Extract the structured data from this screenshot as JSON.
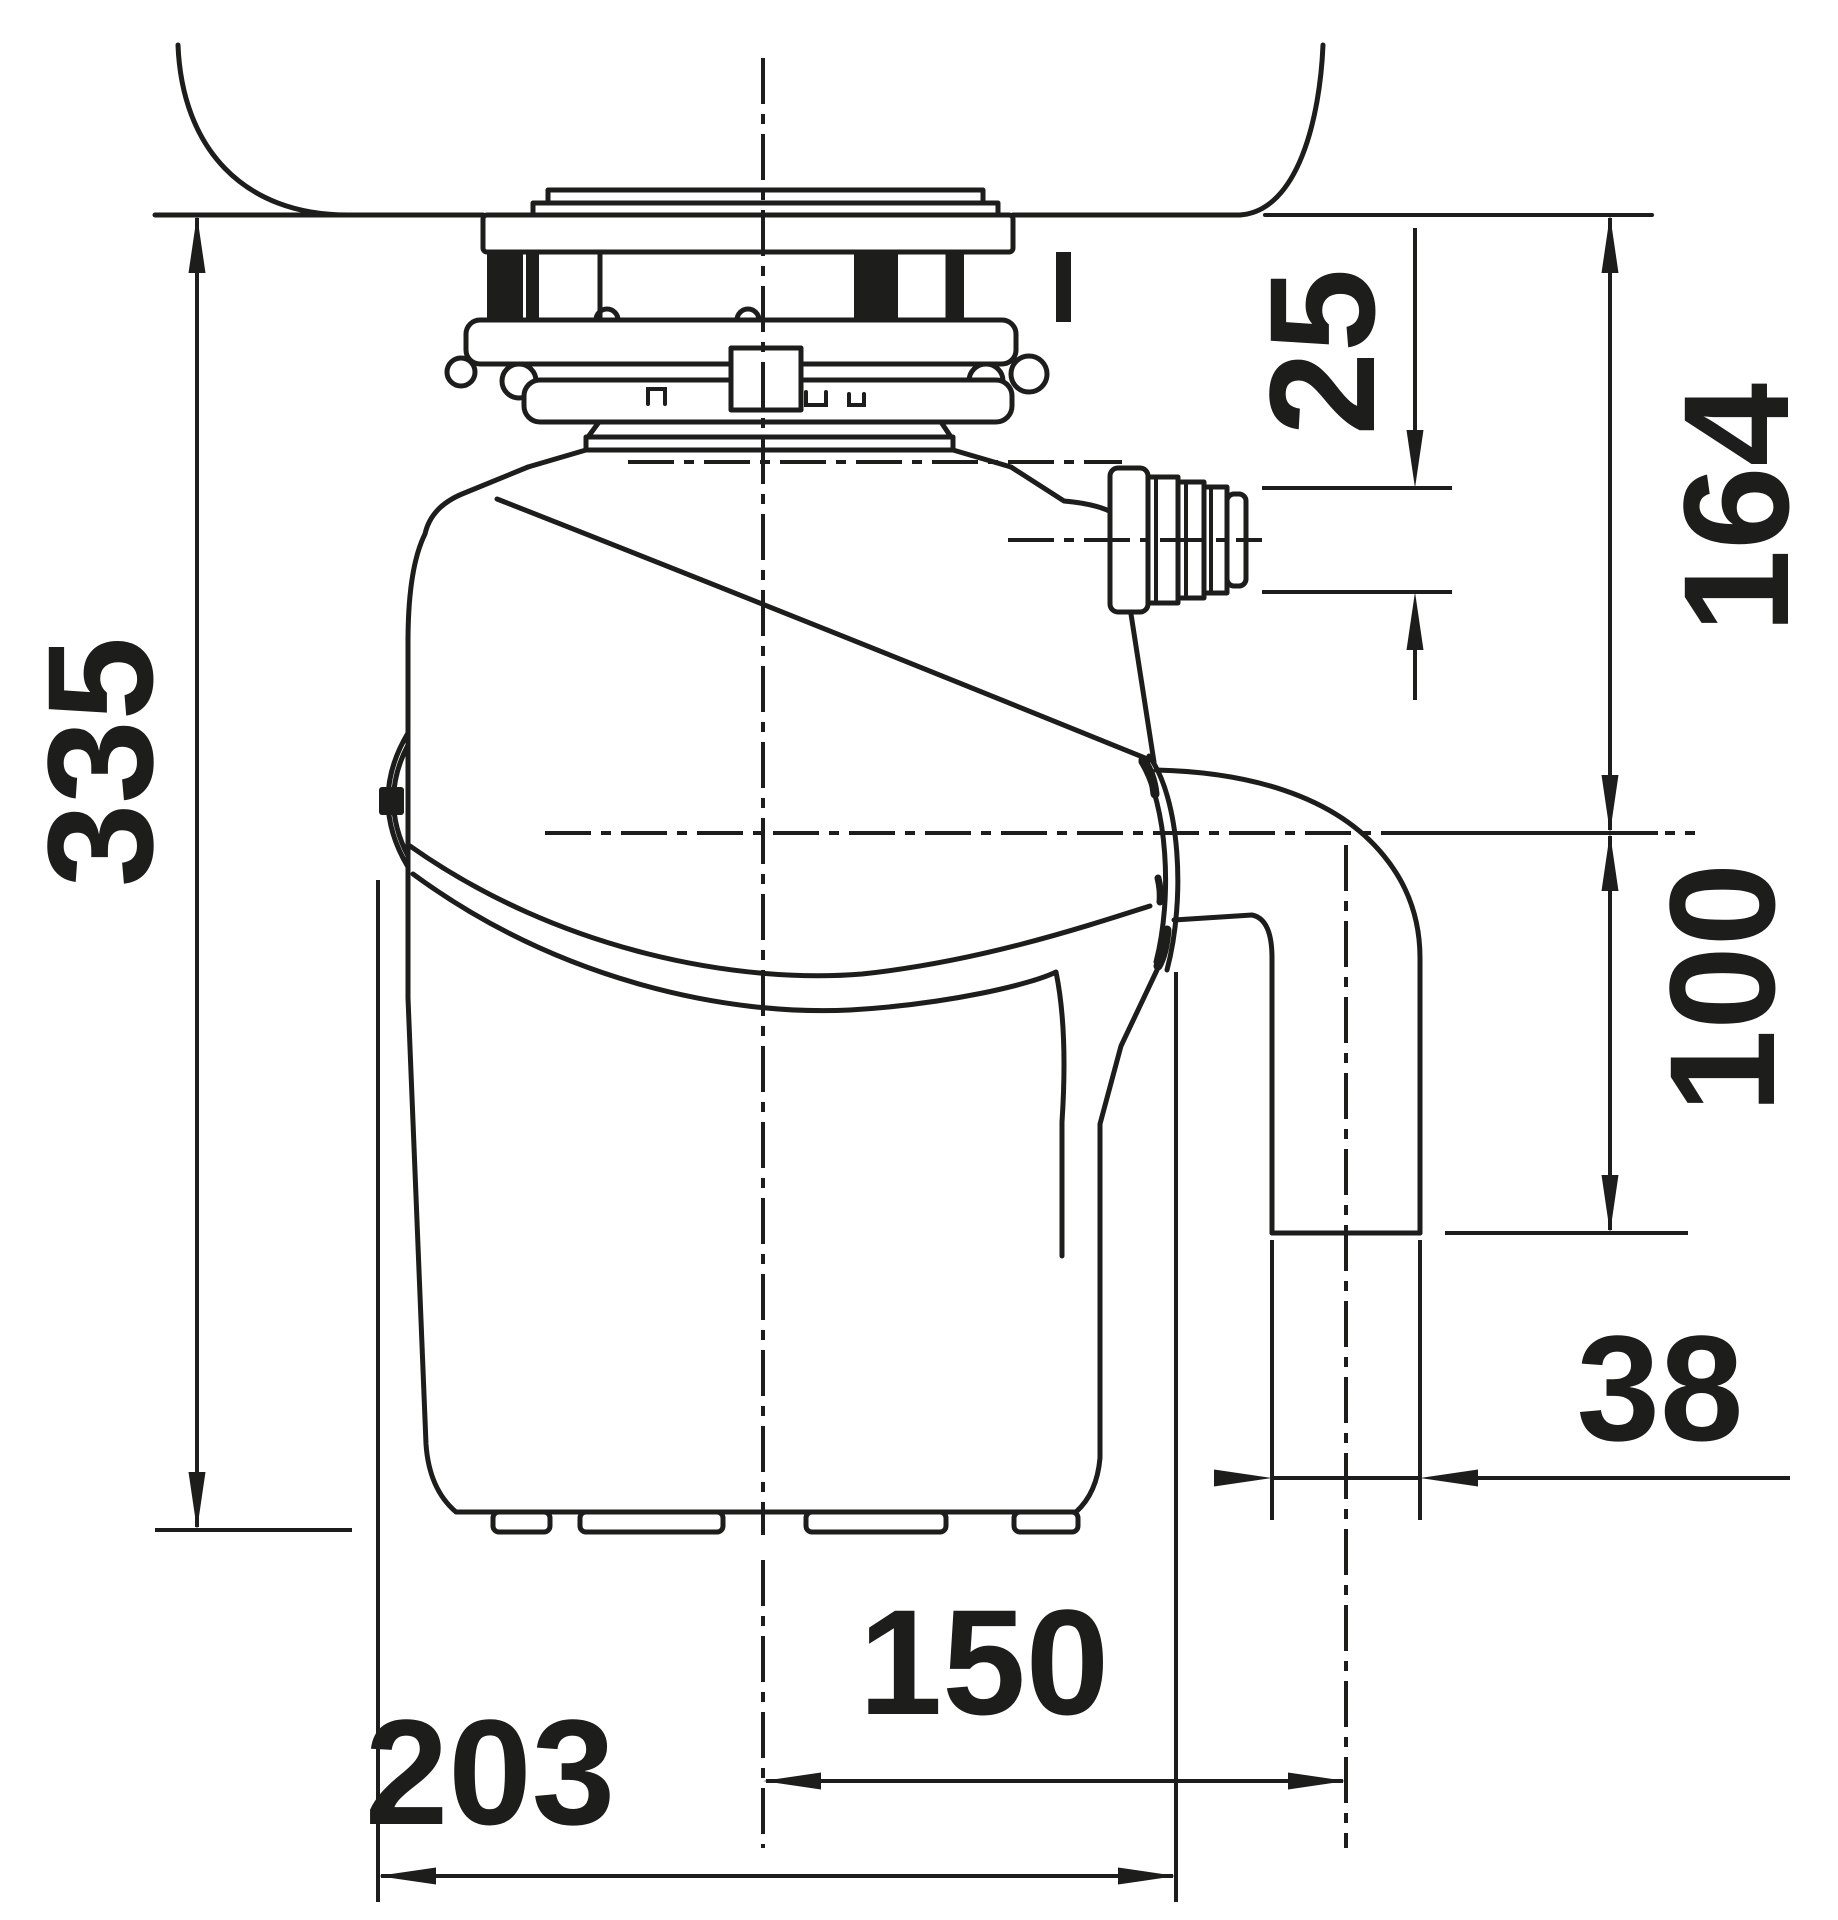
{
  "page": {
    "background_color": "#ffffff",
    "line_color": "#1d1d1b"
  },
  "drawing": {
    "type": "technical-dimension-drawing",
    "subject": "waste disposer unit mounted under sink, side view with installation dimensions",
    "dimensions": {
      "overall_height": "335",
      "inlet_connection_diameter": "25",
      "sink_bottom_to_outlet_center": "164",
      "outlet_center_to_pipe_end": "100",
      "outlet_pipe_diameter": "38",
      "body_center_to_outlet_center": "150",
      "max_body_width": "203"
    }
  }
}
